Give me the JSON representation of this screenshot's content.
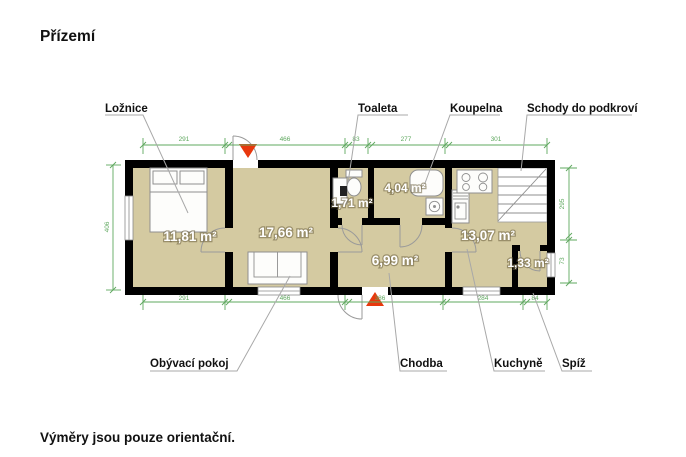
{
  "title": "Přízemí",
  "footer": "Výměry jsou pouze orientační.",
  "rooms": {
    "loznice": {
      "label": "Ložnice",
      "area": "11,81 m²"
    },
    "obyvaci_pokoj": {
      "label": "Obývací pokoj",
      "area": "17,66 m²"
    },
    "toaleta": {
      "label": "Toaleta",
      "area": "1,71 m²"
    },
    "koupelna": {
      "label": "Koupelna",
      "area": "4,04 m²"
    },
    "chodba": {
      "label": "Chodba",
      "area": "6,99 m²"
    },
    "kuchyne": {
      "label": "Kuchyně",
      "area": "13,07 m²"
    },
    "spiz": {
      "label": "Spíž",
      "area": "1,33 m²"
    },
    "schody": {
      "label": "Schody do podkroví"
    }
  },
  "dimensions": {
    "top": [
      "291",
      "466",
      "83",
      "277",
      "301"
    ],
    "bottom": [
      "291",
      "466",
      "386",
      "284",
      "84"
    ],
    "left": [
      "406"
    ],
    "right": [
      "295",
      "73"
    ]
  },
  "colors": {
    "floor": "#d4caa1",
    "wall": "#000000",
    "dim": "#5fa85f",
    "leader": "#a8a8a8",
    "arrow": "#e8380d",
    "fixture": "#8f8f8f",
    "text": "#111111",
    "area_text": "#ffffff"
  }
}
